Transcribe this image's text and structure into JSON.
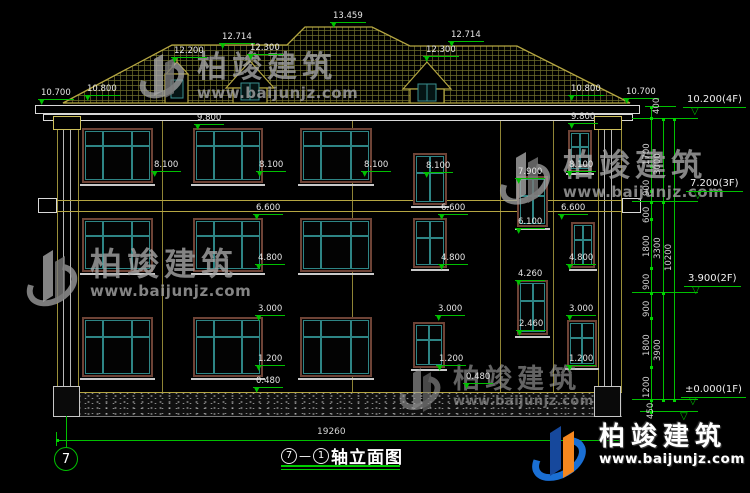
{
  "drawing": {
    "title": {
      "axis_from": "7",
      "separator": "—",
      "axis_to": "1",
      "name": "轴立面图"
    },
    "bottom_axis_bubble": "7",
    "overall_width": "19260"
  },
  "watermark": {
    "brand": "柏竣建筑",
    "url": "www.baijunjz.com"
  },
  "elevation_labels": [
    {
      "t": "13.459",
      "x": 330,
      "y": 12
    },
    {
      "t": "12.714",
      "x": 219,
      "y": 33
    },
    {
      "t": "12.714",
      "x": 448,
      "y": 31
    },
    {
      "t": "12.200",
      "x": 171,
      "y": 47
    },
    {
      "t": "12.300",
      "x": 247,
      "y": 44
    },
    {
      "t": "12.300",
      "x": 423,
      "y": 46
    },
    {
      "t": "10.700",
      "x": 38,
      "y": 89
    },
    {
      "t": "10.800",
      "x": 84,
      "y": 85
    },
    {
      "t": "10.800",
      "x": 568,
      "y": 85
    },
    {
      "t": "10.700",
      "x": 623,
      "y": 88
    },
    {
      "t": "9.800",
      "x": 194,
      "y": 114
    },
    {
      "t": "9.800",
      "x": 568,
      "y": 113
    },
    {
      "t": "8.100",
      "x": 151,
      "y": 161
    },
    {
      "t": "8.100",
      "x": 256,
      "y": 161
    },
    {
      "t": "8.100",
      "x": 361,
      "y": 161
    },
    {
      "t": "8.100",
      "x": 423,
      "y": 162
    },
    {
      "t": "8.100",
      "x": 566,
      "y": 161
    },
    {
      "t": "7.900",
      "x": 515,
      "y": 168
    },
    {
      "t": "6.600",
      "x": 253,
      "y": 204
    },
    {
      "t": "6.600",
      "x": 438,
      "y": 204
    },
    {
      "t": "6.600",
      "x": 558,
      "y": 204
    },
    {
      "t": "6.100",
      "x": 515,
      "y": 218
    },
    {
      "t": "4.800",
      "x": 255,
      "y": 254
    },
    {
      "t": "4.800",
      "x": 438,
      "y": 254
    },
    {
      "t": "4.800",
      "x": 566,
      "y": 254
    },
    {
      "t": "4.260",
      "x": 515,
      "y": 270
    },
    {
      "t": "3.000",
      "x": 255,
      "y": 305
    },
    {
      "t": "3.000",
      "x": 435,
      "y": 305
    },
    {
      "t": "3.000",
      "x": 566,
      "y": 305
    },
    {
      "t": "2.460",
      "x": 516,
      "y": 320
    },
    {
      "t": "1.200",
      "x": 255,
      "y": 355
    },
    {
      "t": "1.200",
      "x": 436,
      "y": 355
    },
    {
      "t": "1.200",
      "x": 566,
      "y": 355
    },
    {
      "t": "0.480",
      "x": 253,
      "y": 377
    },
    {
      "t": "0.480",
      "x": 463,
      "y": 373
    }
  ],
  "floor_markers": [
    {
      "t": "10.200(4F)",
      "x": 683,
      "y": 95
    },
    {
      "t": "7.200(3F)",
      "x": 686,
      "y": 179
    },
    {
      "t": "3.900(2F)",
      "x": 684,
      "y": 274
    },
    {
      "t": "±0.000(1F)",
      "x": 681,
      "y": 385
    }
  ],
  "vertical_dims": [
    {
      "t": "400",
      "x": 653,
      "y": 114
    },
    {
      "t": "1700",
      "x": 643,
      "y": 165
    },
    {
      "t": "3000",
      "x": 654,
      "y": 175
    },
    {
      "t": "900",
      "x": 643,
      "y": 196
    },
    {
      "t": "600",
      "x": 643,
      "y": 223
    },
    {
      "t": "1800",
      "x": 643,
      "y": 257
    },
    {
      "t": "3300",
      "x": 654,
      "y": 259
    },
    {
      "t": "900",
      "x": 643,
      "y": 290
    },
    {
      "t": "900",
      "x": 643,
      "y": 317
    },
    {
      "t": "1800",
      "x": 643,
      "y": 356
    },
    {
      "t": "3900",
      "x": 654,
      "y": 361
    },
    {
      "t": "10200",
      "x": 665,
      "y": 271
    },
    {
      "t": "1200",
      "x": 643,
      "y": 398
    },
    {
      "t": "450",
      "x": 647,
      "y": 419
    }
  ],
  "colors": {
    "dim_green": "#00c000",
    "roof_tan": "#b5a642",
    "window_frame_teal": "#2e8585",
    "window_surround_brown": "#6e4336",
    "logo_blue": "#1a6fd4",
    "logo_orange": "#f5871f"
  }
}
